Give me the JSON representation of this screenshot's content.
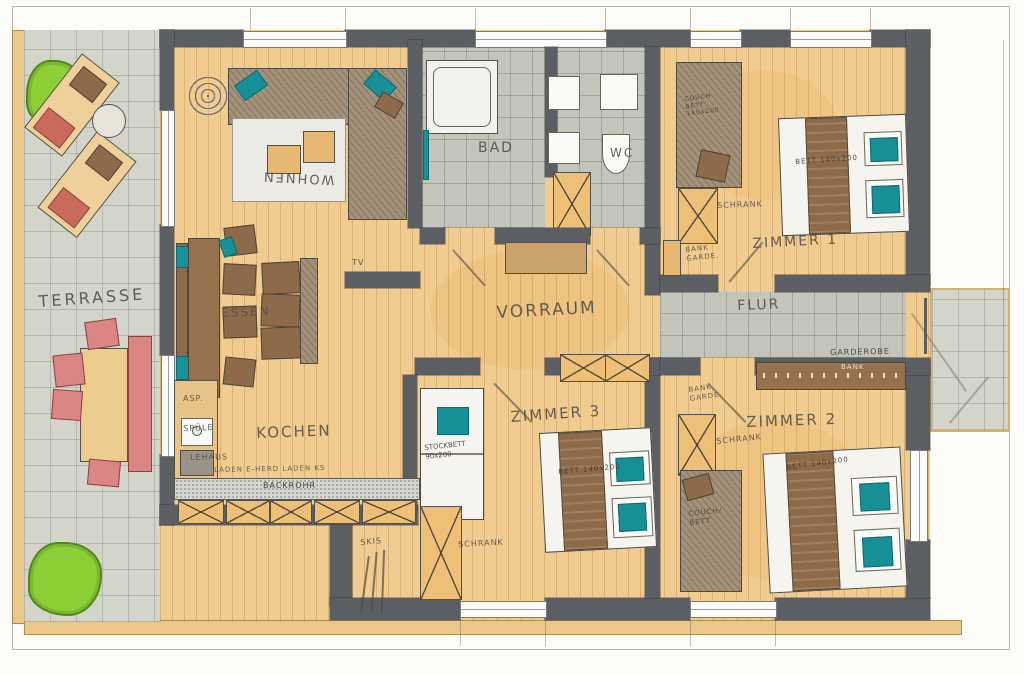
{
  "rooms": {
    "terrasse": "TERRASSE",
    "wohnen": "WOHNEN",
    "bad": "BAD",
    "wc": "WC",
    "zimmer1": "ZIMMER 1",
    "essen": "ESSEN",
    "kochen": "KOCHEN",
    "vorraum": "VORRAUM",
    "flur": "FLUR",
    "zimmer3": "ZIMMER 3",
    "zimmer2": "ZIMMER 2"
  },
  "labels": {
    "tv": "TV",
    "asp": "ASP.",
    "spuele": "SPÜLE",
    "lehaus": "LEHAUS",
    "kitchen_units": "LADEN E-HERD LADEN KS",
    "backrohr": "BACKROHR",
    "skis": "SKIS",
    "schrank_z1": "SCHRANK",
    "schrank_z2": "SCHRANK",
    "schrank_z3": "SCHRANK",
    "stockbett": "STOCKBETT\n90x200",
    "bett_z1": "BETT 140x200",
    "bett_z2": "BETT 140x200",
    "bett_z3": "BETT 140x200",
    "couchbett_z1": "COUCH\nBETT\n140x200",
    "couchbett_z2": "COUCH/\nBETT",
    "bankgarde_z1": "BANK\nGARDE.",
    "bankgarde_z2": "BANK\nGARDE.",
    "garderobe": "GARDEROBE",
    "bank": "BANK"
  },
  "colors": {
    "wall": "#5b5f64",
    "wood_floor": "#f1cc90",
    "bath_tile": "#c3c5ba",
    "terrace_tile": "#d3d5cb",
    "furniture_brown": "#8d6a49",
    "teal_accent": "#189098",
    "bedding_white": "#f5f4ef",
    "chair_red": "#db8585",
    "bush_green": "#8ccf36",
    "cabinet_orange": "#edbf77",
    "pencil": "#57544b"
  }
}
